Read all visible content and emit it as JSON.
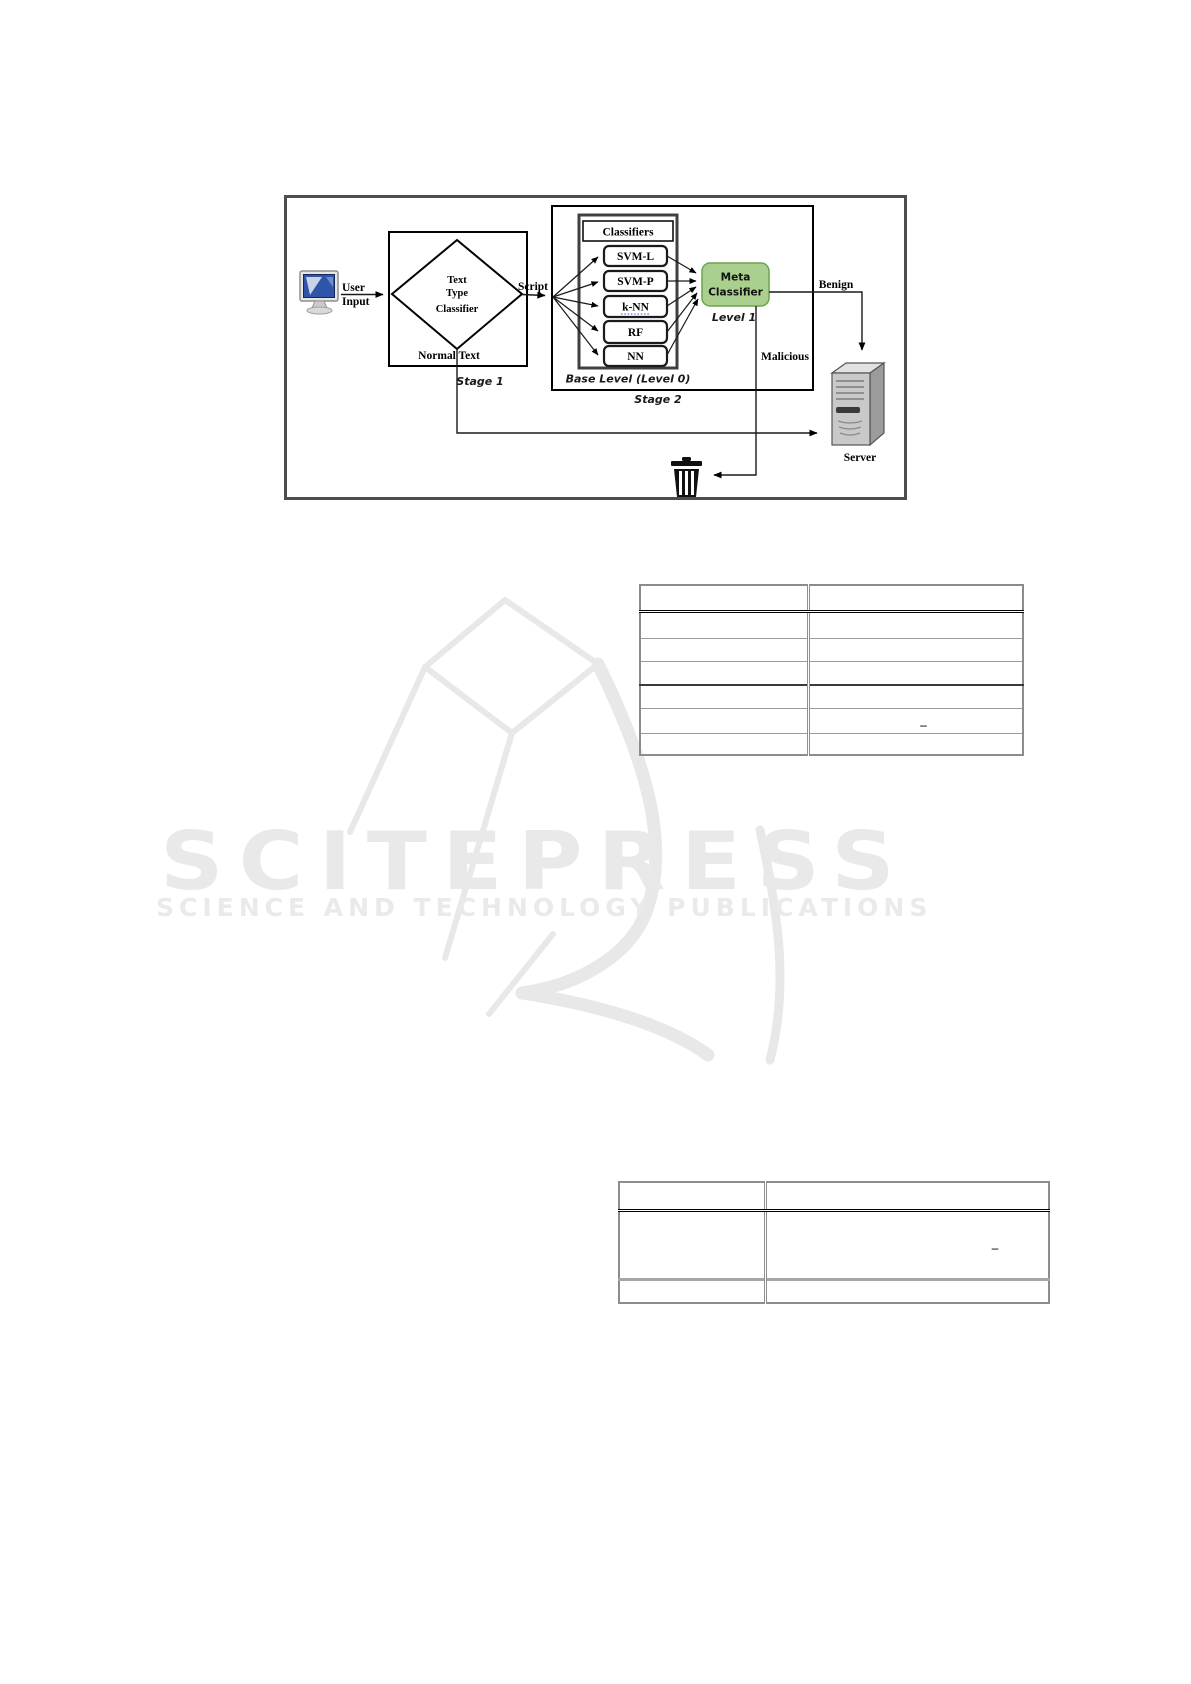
{
  "figure": {
    "user_input": {
      "line1": "User",
      "line2": "Input"
    },
    "stage1": {
      "diamond_line1": "Text",
      "diamond_line2": "Type",
      "diamond_line3": "Classifier",
      "normal_text_label": "Normal Text",
      "stage_label": "Stage 1"
    },
    "script_label": "Script",
    "stage2": {
      "classifiers_header": "Classifiers",
      "classifiers": [
        "SVM-L",
        "SVM-P",
        "k-NN",
        "RF",
        "NN"
      ],
      "base_level_label": "Base Level (Level 0)",
      "stage_label": "Stage 2"
    },
    "meta": {
      "line1": "Meta",
      "line2": "Classifier",
      "level_label": "Level 1",
      "fill_color": "#a9d08e",
      "border_color": "#6fa350"
    },
    "benign_label": "Benign",
    "malicious_label": "Malicious",
    "server_label": "Server"
  },
  "table1": {
    "rows": [
      [
        "",
        ""
      ],
      [
        "",
        ""
      ],
      [
        "",
        ""
      ],
      [
        "",
        ""
      ],
      [
        "",
        ""
      ],
      [
        "",
        "–"
      ],
      [
        "",
        ""
      ]
    ]
  },
  "table2": {
    "rows": [
      [
        "",
        ""
      ],
      [
        "",
        "–"
      ],
      [
        "",
        ""
      ]
    ]
  },
  "watermark": {
    "title": "SCITEPRESS",
    "subtitle": "SCIENCE AND TECHNOLOGY PUBLICATIONS",
    "color": "#e9e9e9"
  }
}
